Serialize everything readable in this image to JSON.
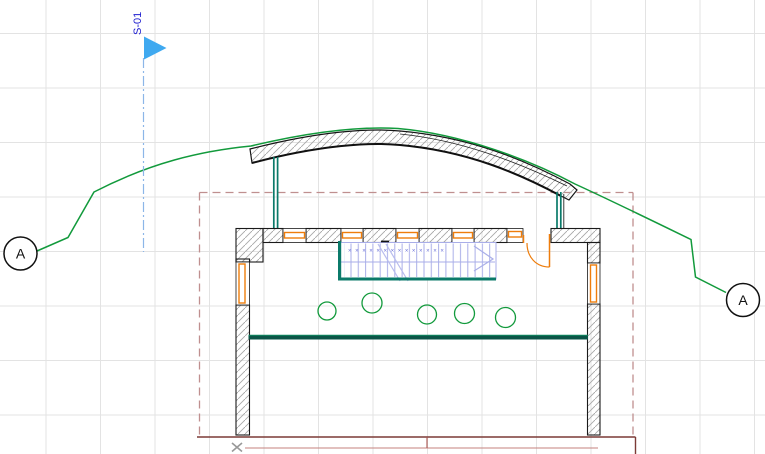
{
  "section_marker": {
    "label": "S-01"
  },
  "grid_bubbles": {
    "left_label": "A",
    "right_label": "A"
  },
  "stair": {
    "tread_marks": "××××××××××××××"
  },
  "colors": {
    "section_flag_blue": "#3fa9f0",
    "section_text_blue": "#1c1ccf",
    "section_line_blue": "#8cb6e8",
    "pen_green": "#129a3c",
    "pen_teal": "#0b7a6a",
    "pen_dark_teal": "#0b5547",
    "pen_teal_highlight": "#0f8a60",
    "pen_orange": "#ee7d0c",
    "outline_dashed_maroon": "#bf8f8f",
    "terrace_maroon_dark": "#7c3a36",
    "terrace_maroon_light": "#c4827e",
    "terrace_maroon_mid": "#a8534e",
    "stair_blue": "#a9aee8",
    "stair_mark_blue": "#6b70d8",
    "wall_black": "#1a1a1a",
    "hatch_gray": "#a7a7a7",
    "hotspot_gray": "#999999",
    "grid_gray": "#e3e3e3"
  }
}
